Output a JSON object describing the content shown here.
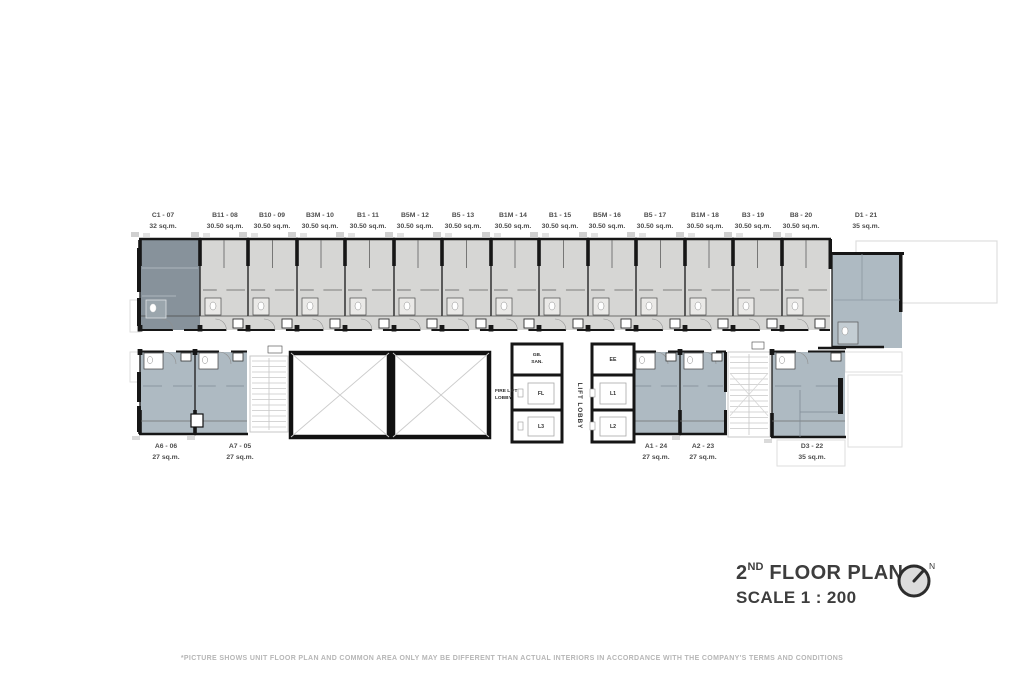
{
  "title_block": {
    "number": "2",
    "ordinal": "ND",
    "name": "FLOOR PLAN",
    "scale": "SCALE 1 : 200",
    "north": "N"
  },
  "disclaimer": "*PICTURE SHOWS UNIT FLOOR PLAN AND COMMON AREA ONLY MAY BE DIFFERENT THAN ACTUAL INTERIORS IN ACCORDANCE WITH THE COMPANY'S TERMS AND CONDITIONS",
  "colors": {
    "unit_gray": "#d6d6d4",
    "unit_dark": "#87929b",
    "unit_blue": "#aebac2",
    "wall": "#161616",
    "inner_gray": "#5f5f5f",
    "inner_blue": "#7f8b95",
    "label": "#4e4e4e",
    "title": "#3d3d3d",
    "disclaimer": "#b6b6b6",
    "faint": "#dedede",
    "stair": "#c7c7c7"
  },
  "plan": {
    "top_units": [
      {
        "id": "C1 - 07",
        "area": "32 sq.m.",
        "x": 140,
        "w": 60,
        "lx": 163,
        "variant": "dark"
      },
      {
        "id": "B11 - 08",
        "area": "30.50 sq.m.",
        "x": 200,
        "w": 48,
        "lx": 225,
        "variant": "std"
      },
      {
        "id": "B10 - 09",
        "area": "30.50 sq.m.",
        "x": 248,
        "w": 49,
        "lx": 272,
        "variant": "std"
      },
      {
        "id": "B3M - 10",
        "area": "30.50 sq.m.",
        "x": 297,
        "w": 48,
        "lx": 320,
        "variant": "std"
      },
      {
        "id": "B1 - 11",
        "area": "30.50 sq.m.",
        "x": 345,
        "w": 49,
        "lx": 368,
        "variant": "std"
      },
      {
        "id": "B5M - 12",
        "area": "30.50 sq.m.",
        "x": 394,
        "w": 48,
        "lx": 415,
        "variant": "std"
      },
      {
        "id": "B5 - 13",
        "area": "30.50 sq.m.",
        "x": 442,
        "w": 49,
        "lx": 463,
        "variant": "std"
      },
      {
        "id": "B1M - 14",
        "area": "30.50 sq.m.",
        "x": 491,
        "w": 48,
        "lx": 513,
        "variant": "std"
      },
      {
        "id": "B1 - 15",
        "area": "30.50 sq.m.",
        "x": 539,
        "w": 49,
        "lx": 560,
        "variant": "std"
      },
      {
        "id": "B5M - 16",
        "area": "30.50 sq.m.",
        "x": 588,
        "w": 48,
        "lx": 607,
        "variant": "std"
      },
      {
        "id": "B5 - 17",
        "area": "30.50 sq.m.",
        "x": 636,
        "w": 49,
        "lx": 655,
        "variant": "std"
      },
      {
        "id": "B1M - 18",
        "area": "30.50 sq.m.",
        "x": 685,
        "w": 48,
        "lx": 705,
        "variant": "std"
      },
      {
        "id": "B3 - 19",
        "area": "30.50 sq.m.",
        "x": 733,
        "w": 49,
        "lx": 753,
        "variant": "std"
      },
      {
        "id": "B8 - 20",
        "area": "30.50 sq.m.",
        "x": 782,
        "w": 48,
        "lx": 801,
        "variant": "std"
      },
      {
        "id": "D1 - 21",
        "area": "35 sq.m.",
        "x": 832,
        "w": 70,
        "lx": 866,
        "variant": "d1"
      }
    ],
    "bottom_units": [
      {
        "id": "A6 - 06",
        "area": "27 sq.m.",
        "x": 140,
        "w": 55,
        "lx": 166,
        "variant": "a"
      },
      {
        "id": "A7 - 05",
        "area": "27 sq.m.",
        "x": 195,
        "w": 52,
        "lx": 240,
        "variant": "a"
      },
      {
        "id": "A1 - 24",
        "area": "27 sq.m.",
        "x": 632,
        "w": 48,
        "lx": 656,
        "variant": "a"
      },
      {
        "id": "A2 - 23",
        "area": "27 sq.m.",
        "x": 680,
        "w": 46,
        "lx": 703,
        "variant": "a"
      },
      {
        "id": "D3 - 22",
        "area": "35 sq.m.",
        "x": 772,
        "w": 73,
        "lx": 812,
        "variant": "d3"
      }
    ],
    "core": {
      "gb_san_lines": [
        "GB.",
        "SAN."
      ],
      "ee": "EE",
      "fire_lift_lobby_lines": [
        "FIRE LIFT",
        "LOBBY"
      ],
      "lift_lobby": "LIFT LOBBY",
      "lifts": [
        {
          "label": "FL",
          "x": 524,
          "y": 378,
          "w": 34,
          "h": 30
        },
        {
          "label": "L3",
          "x": 524,
          "y": 412,
          "w": 34,
          "h": 28
        },
        {
          "label": "L1",
          "x": 596,
          "y": 378,
          "w": 34,
          "h": 30
        },
        {
          "label": "L2",
          "x": 596,
          "y": 412,
          "w": 34,
          "h": 28
        }
      ]
    }
  }
}
